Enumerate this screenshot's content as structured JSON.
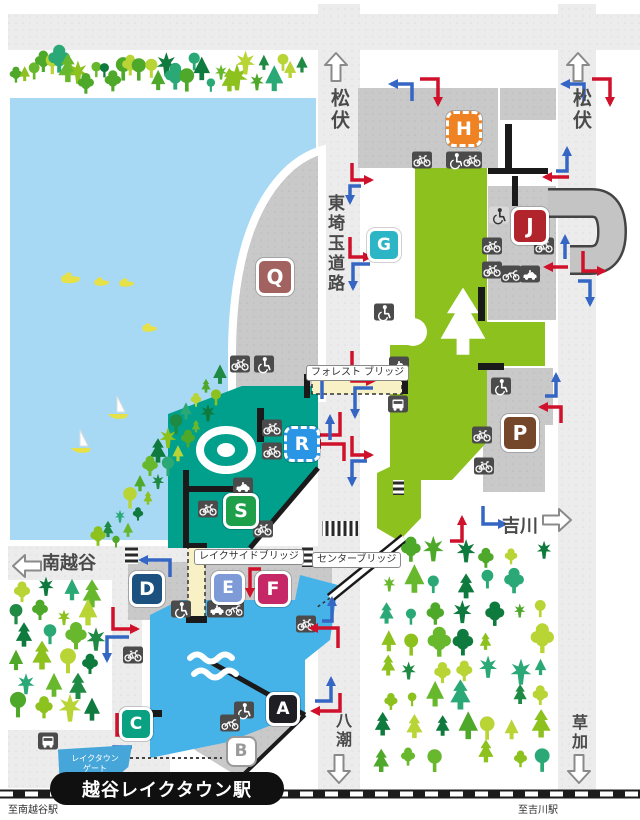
{
  "directions": {
    "matsubushi_left": "松伏",
    "matsubushi_right": "松伏",
    "minami_koshigaya": "南越谷",
    "yoshikawa": "吉川",
    "yashio": "八潮",
    "soka": "草加",
    "to_minami_koshigaya_station": "至南越谷駅",
    "to_yoshikawa_station": "至吉川駅"
  },
  "road_name": "東埼玉道路",
  "bridges": {
    "forest": "フォレスト ブリッジ",
    "lakeside": "レイクサイドブリッジ",
    "center": "センターブリッジ"
  },
  "station": {
    "name": "越谷レイクタウン駅"
  },
  "gate": {
    "line1": "レイクタウン",
    "line2": "ゲート"
  },
  "colors": {
    "road": "#ececec",
    "lot": "#c9c9c9",
    "lake": "#a7d9f4",
    "pond": "#45b3e8",
    "teal_building": "#00a08c",
    "green_building": "#8cc11e",
    "bridge_deck": "#f8f1c6",
    "arrow_red": "#d0112b",
    "arrow_blue": "#3566c4",
    "icon_dark": "#4b4b4b"
  },
  "markers": [
    {
      "label": "H",
      "x": 461,
      "y": 126,
      "size": 30,
      "color": "#ef8222",
      "style": "dashed"
    },
    {
      "label": "G",
      "x": 381,
      "y": 242,
      "size": 28,
      "color": "#2cb5c5",
      "style": "solid"
    },
    {
      "label": "Q",
      "x": 272,
      "y": 274,
      "size": 32,
      "color": "#a2625f",
      "style": "solid"
    },
    {
      "label": "J",
      "x": 527,
      "y": 223,
      "size": 32,
      "color": "#b2242c",
      "style": "solid"
    },
    {
      "label": "P",
      "x": 517,
      "y": 430,
      "size": 32,
      "color": "#74462a",
      "style": "solid"
    },
    {
      "label": "R",
      "x": 299,
      "y": 441,
      "size": 30,
      "color": "#2a95e5",
      "style": "dashed"
    },
    {
      "label": "S",
      "x": 238,
      "y": 508,
      "size": 30,
      "color": "#1ea04b",
      "style": "solid"
    },
    {
      "label": "D",
      "x": 144,
      "y": 586,
      "size": 30,
      "color": "#1c507e",
      "style": "solid"
    },
    {
      "label": "E",
      "x": 225,
      "y": 585,
      "size": 28,
      "color": "#7e9ad7",
      "style": "solid"
    },
    {
      "label": "F",
      "x": 270,
      "y": 586,
      "size": 30,
      "color": "#c52767",
      "style": "solid"
    },
    {
      "label": "C",
      "x": 133,
      "y": 721,
      "size": 28,
      "color": "#0aa182",
      "style": "solid"
    },
    {
      "label": "A",
      "x": 280,
      "y": 706,
      "size": 28,
      "color": "#1f1f23",
      "style": "solid"
    },
    {
      "label": "B",
      "x": 239,
      "y": 749,
      "size": 27,
      "color": "#ffffff",
      "style": "outline"
    }
  ],
  "icons": [
    {
      "type": "bicycle",
      "x": 422,
      "y": 160
    },
    {
      "type": "wheelchair",
      "x": 456,
      "y": 160
    },
    {
      "type": "bicycle",
      "x": 472,
      "y": 160
    },
    {
      "type": "wheelchair",
      "x": 499,
      "y": 215,
      "variant": "light"
    },
    {
      "type": "bicycle",
      "x": 492,
      "y": 246
    },
    {
      "type": "bicycle",
      "x": 544,
      "y": 246
    },
    {
      "type": "bicycle",
      "x": 492,
      "y": 270
    },
    {
      "type": "motorcycle",
      "x": 511,
      "y": 274
    },
    {
      "type": "taxi",
      "x": 530,
      "y": 274
    },
    {
      "type": "wheelchair",
      "x": 384,
      "y": 312
    },
    {
      "type": "taxi",
      "x": 399,
      "y": 365
    },
    {
      "type": "bus",
      "x": 398,
      "y": 404
    },
    {
      "type": "bicycle",
      "x": 240,
      "y": 364
    },
    {
      "type": "wheelchair",
      "x": 264,
      "y": 364
    },
    {
      "type": "bicycle",
      "x": 272,
      "y": 428
    },
    {
      "type": "bicycle",
      "x": 272,
      "y": 451
    },
    {
      "type": "wheelchair",
      "x": 501,
      "y": 386
    },
    {
      "type": "bicycle",
      "x": 482,
      "y": 435
    },
    {
      "type": "bicycle",
      "x": 484,
      "y": 466
    },
    {
      "type": "taxi",
      "x": 243,
      "y": 486
    },
    {
      "type": "bicycle",
      "x": 208,
      "y": 509
    },
    {
      "type": "bicycle",
      "x": 263,
      "y": 529
    },
    {
      "type": "wheelchair",
      "x": 181,
      "y": 609
    },
    {
      "type": "taxi",
      "x": 217,
      "y": 609
    },
    {
      "type": "motorcycle",
      "x": 234,
      "y": 609
    },
    {
      "type": "bicycle",
      "x": 133,
      "y": 655
    },
    {
      "type": "bicycle",
      "x": 306,
      "y": 624
    },
    {
      "type": "wheelchair",
      "x": 244,
      "y": 710
    },
    {
      "type": "motorcycle",
      "x": 230,
      "y": 723
    },
    {
      "type": "bus",
      "x": 48,
      "y": 741
    }
  ],
  "arrows": [
    {
      "c": "blue",
      "d": "M412,101 L412,84 L391,84"
    },
    {
      "c": "red",
      "d": "M420,79 L438,79 L438,104"
    },
    {
      "c": "blue",
      "d": "M584,101 L584,84 L563,84"
    },
    {
      "c": "red",
      "d": "M592,79 L610,79 L610,104"
    },
    {
      "c": "red",
      "d": "M352,163 L352,180 L371,180"
    },
    {
      "c": "blue",
      "d": "M361,186 L350,186 L350,202"
    },
    {
      "c": "red",
      "d": "M350,237 L350,257 L370,257"
    },
    {
      "c": "blue",
      "d": "M370,264 L353,264 L353,288"
    },
    {
      "c": "red",
      "d": "M352,351 L352,381 L373,381"
    },
    {
      "c": "blue",
      "d": "M373,388 L355,388 L355,416"
    },
    {
      "c": "blue",
      "d": "M322,399 L322,372"
    },
    {
      "c": "red",
      "d": "M340,412 L340,435 L304,435"
    },
    {
      "c": "red",
      "d": "M352,436 L352,455 L371,455"
    },
    {
      "c": "blue",
      "d": "M367,461 L352,461 L352,484"
    },
    {
      "c": "blue",
      "d": "M330,440 L330,417"
    },
    {
      "c": "red",
      "d": "M344,461 L344,444 L314,444"
    },
    {
      "c": "blue",
      "d": "M556,171 L567,171 L567,149"
    },
    {
      "c": "red",
      "d": "M569,177 L545,177"
    },
    {
      "c": "blue",
      "d": "M565,259 L565,237"
    },
    {
      "c": "red",
      "d": "M568,267 L546,267"
    },
    {
      "c": "red",
      "d": "M583,251 L583,271 L604,271"
    },
    {
      "c": "blue",
      "d": "M578,281 L590,281 L590,304"
    },
    {
      "c": "blue",
      "d": "M545,396 L556,396 L556,375"
    },
    {
      "c": "red",
      "d": "M561,423 L561,407 L541,407"
    },
    {
      "c": "red",
      "d": "M450,541 L462,541 L462,518"
    },
    {
      "c": "blue",
      "d": "M483,506 L483,524 L505,524"
    },
    {
      "c": "red",
      "d": "M261,569 L250,569 L250,595"
    },
    {
      "c": "blue",
      "d": "M170,577 L170,560 L141,560"
    },
    {
      "c": "red",
      "d": "M113,607 L113,629 L137,629"
    },
    {
      "c": "blue",
      "d": "M129,637 L107,637 L107,660"
    },
    {
      "c": "red",
      "d": "M117,713 L117,735 L139,735"
    },
    {
      "c": "blue",
      "d": "M132,747 L114,747 L114,770"
    },
    {
      "c": "red",
      "d": "M338,648 L338,628 L311,628"
    },
    {
      "c": "blue",
      "d": "M322,621 L332,621 L332,599"
    },
    {
      "c": "blue",
      "d": "M315,701 L331,701 L331,679"
    },
    {
      "c": "red",
      "d": "M340,693 L340,711 L313,711"
    }
  ]
}
